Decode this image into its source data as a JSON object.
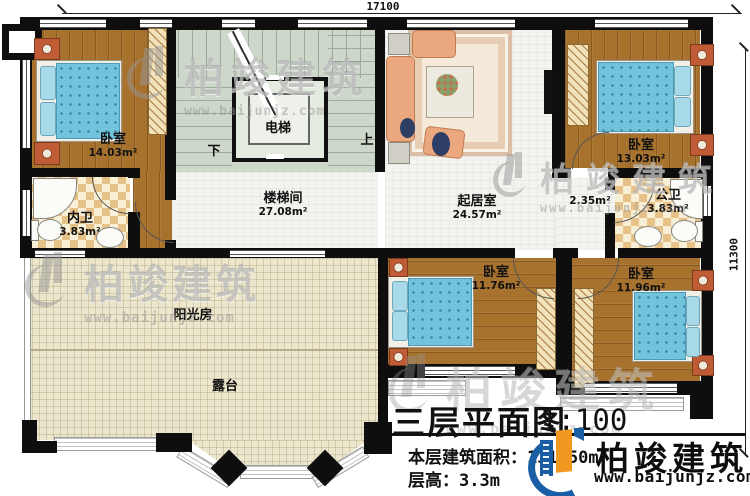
{
  "dimensions": {
    "top": "17100",
    "right": "11300"
  },
  "stairs": {
    "down": "下",
    "up": "上"
  },
  "rooms": {
    "bedroom_tl": {
      "name": "卧室",
      "area": "14.03m²"
    },
    "inner_bath": {
      "name": "内卫",
      "area": "3.83m²"
    },
    "elevator": {
      "name": "电梯"
    },
    "stairwell": {
      "name": "楼梯间",
      "area": "27.08m²"
    },
    "living": {
      "name": "起居室",
      "area": "24.57m²"
    },
    "bedroom_tr": {
      "name": "卧室",
      "area": "13.03m²"
    },
    "public_bath": {
      "name": "公卫",
      "area": "3.83m²"
    },
    "corridor": {
      "area": "2.35m²"
    },
    "sunroom": {
      "name": "阳光房"
    },
    "terrace": {
      "name": "露台"
    },
    "bedroom_bc": {
      "name": "卧室",
      "area": "11.76m²"
    },
    "bedroom_br": {
      "name": "卧室",
      "area": "11.96m²"
    }
  },
  "title_block": {
    "title": "三层平面图",
    "scale": "1:100",
    "area_label": "本层建筑面积：",
    "area_value": "131.50m²",
    "height_label": "层高：",
    "height_value": "3.3m"
  },
  "brand": {
    "name": "柏竣建筑",
    "website": "www.baijunjz.com"
  },
  "watermark": {
    "name": "柏竣建筑",
    "website": "www.baijunjz.com"
  }
}
